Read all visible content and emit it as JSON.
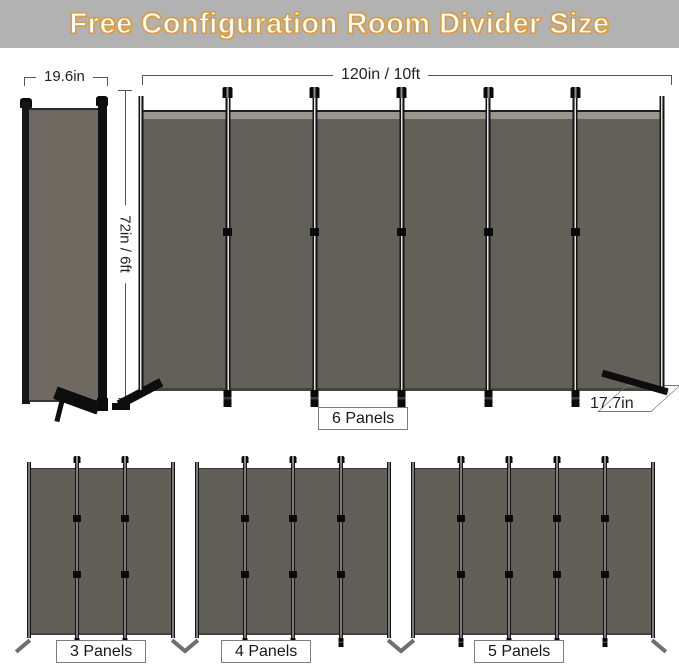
{
  "banner": {
    "title": "Free Configuration Room Divider Size",
    "bg_color": "#b2b2b2",
    "text_color": "#ffffff",
    "outline_color": "#d89e45"
  },
  "dimensions": {
    "folded_width": "19.6in",
    "total_width": "120in / 10ft",
    "height": "72in / 6ft",
    "foot_depth": "17.7in"
  },
  "main_divider": {
    "label": "6 Panels",
    "panels": 6
  },
  "variants": [
    {
      "label": "3 Panels",
      "panels": 3
    },
    {
      "label": "4 Panels",
      "panels": 4
    },
    {
      "label": "5 Panels",
      "panels": 5
    }
  ],
  "colors": {
    "fabric": "#63605a",
    "frame": "#141414",
    "top_strip": "#9b978f"
  }
}
